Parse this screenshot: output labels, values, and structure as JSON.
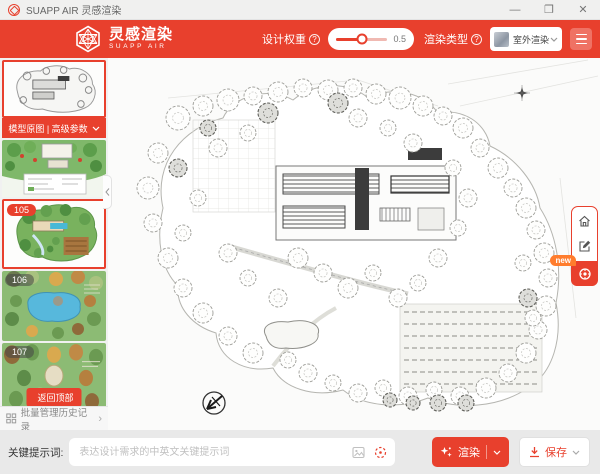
{
  "window": {
    "title": "SUAPP AIR 灵感渲染",
    "minimize": "—",
    "maximize": "❐",
    "close": "✕"
  },
  "header": {
    "brand_cn": "灵感渲染",
    "brand_en": "SUAPP AIR",
    "weight_label": "设计权重",
    "weight_help": "?",
    "weight_value": "0.5",
    "type_label": "渲染类型",
    "type_help": "?",
    "type_value": "室外渲染"
  },
  "sidebar": {
    "banner_label": "模型原图 | 高级参数",
    "items": [
      {
        "badge": ""
      },
      {
        "badge": ""
      },
      {
        "badge": "105"
      },
      {
        "badge": "106"
      },
      {
        "badge": "107"
      }
    ],
    "back_to_top": "返回顶部",
    "footer_label": "批量管理历史记录",
    "footer_chevron": "›"
  },
  "float_toolbar": {
    "new_badge": "new"
  },
  "footer": {
    "prompt_label": "关键提示词:",
    "prompt_placeholder": "表达设计需求的中英文关键提示词",
    "render_label": "渲染",
    "save_label": "保存"
  },
  "colors": {
    "brand_red": "#e8402d",
    "light_red": "#ef7264",
    "accent_orange": "#ff7d2e"
  }
}
